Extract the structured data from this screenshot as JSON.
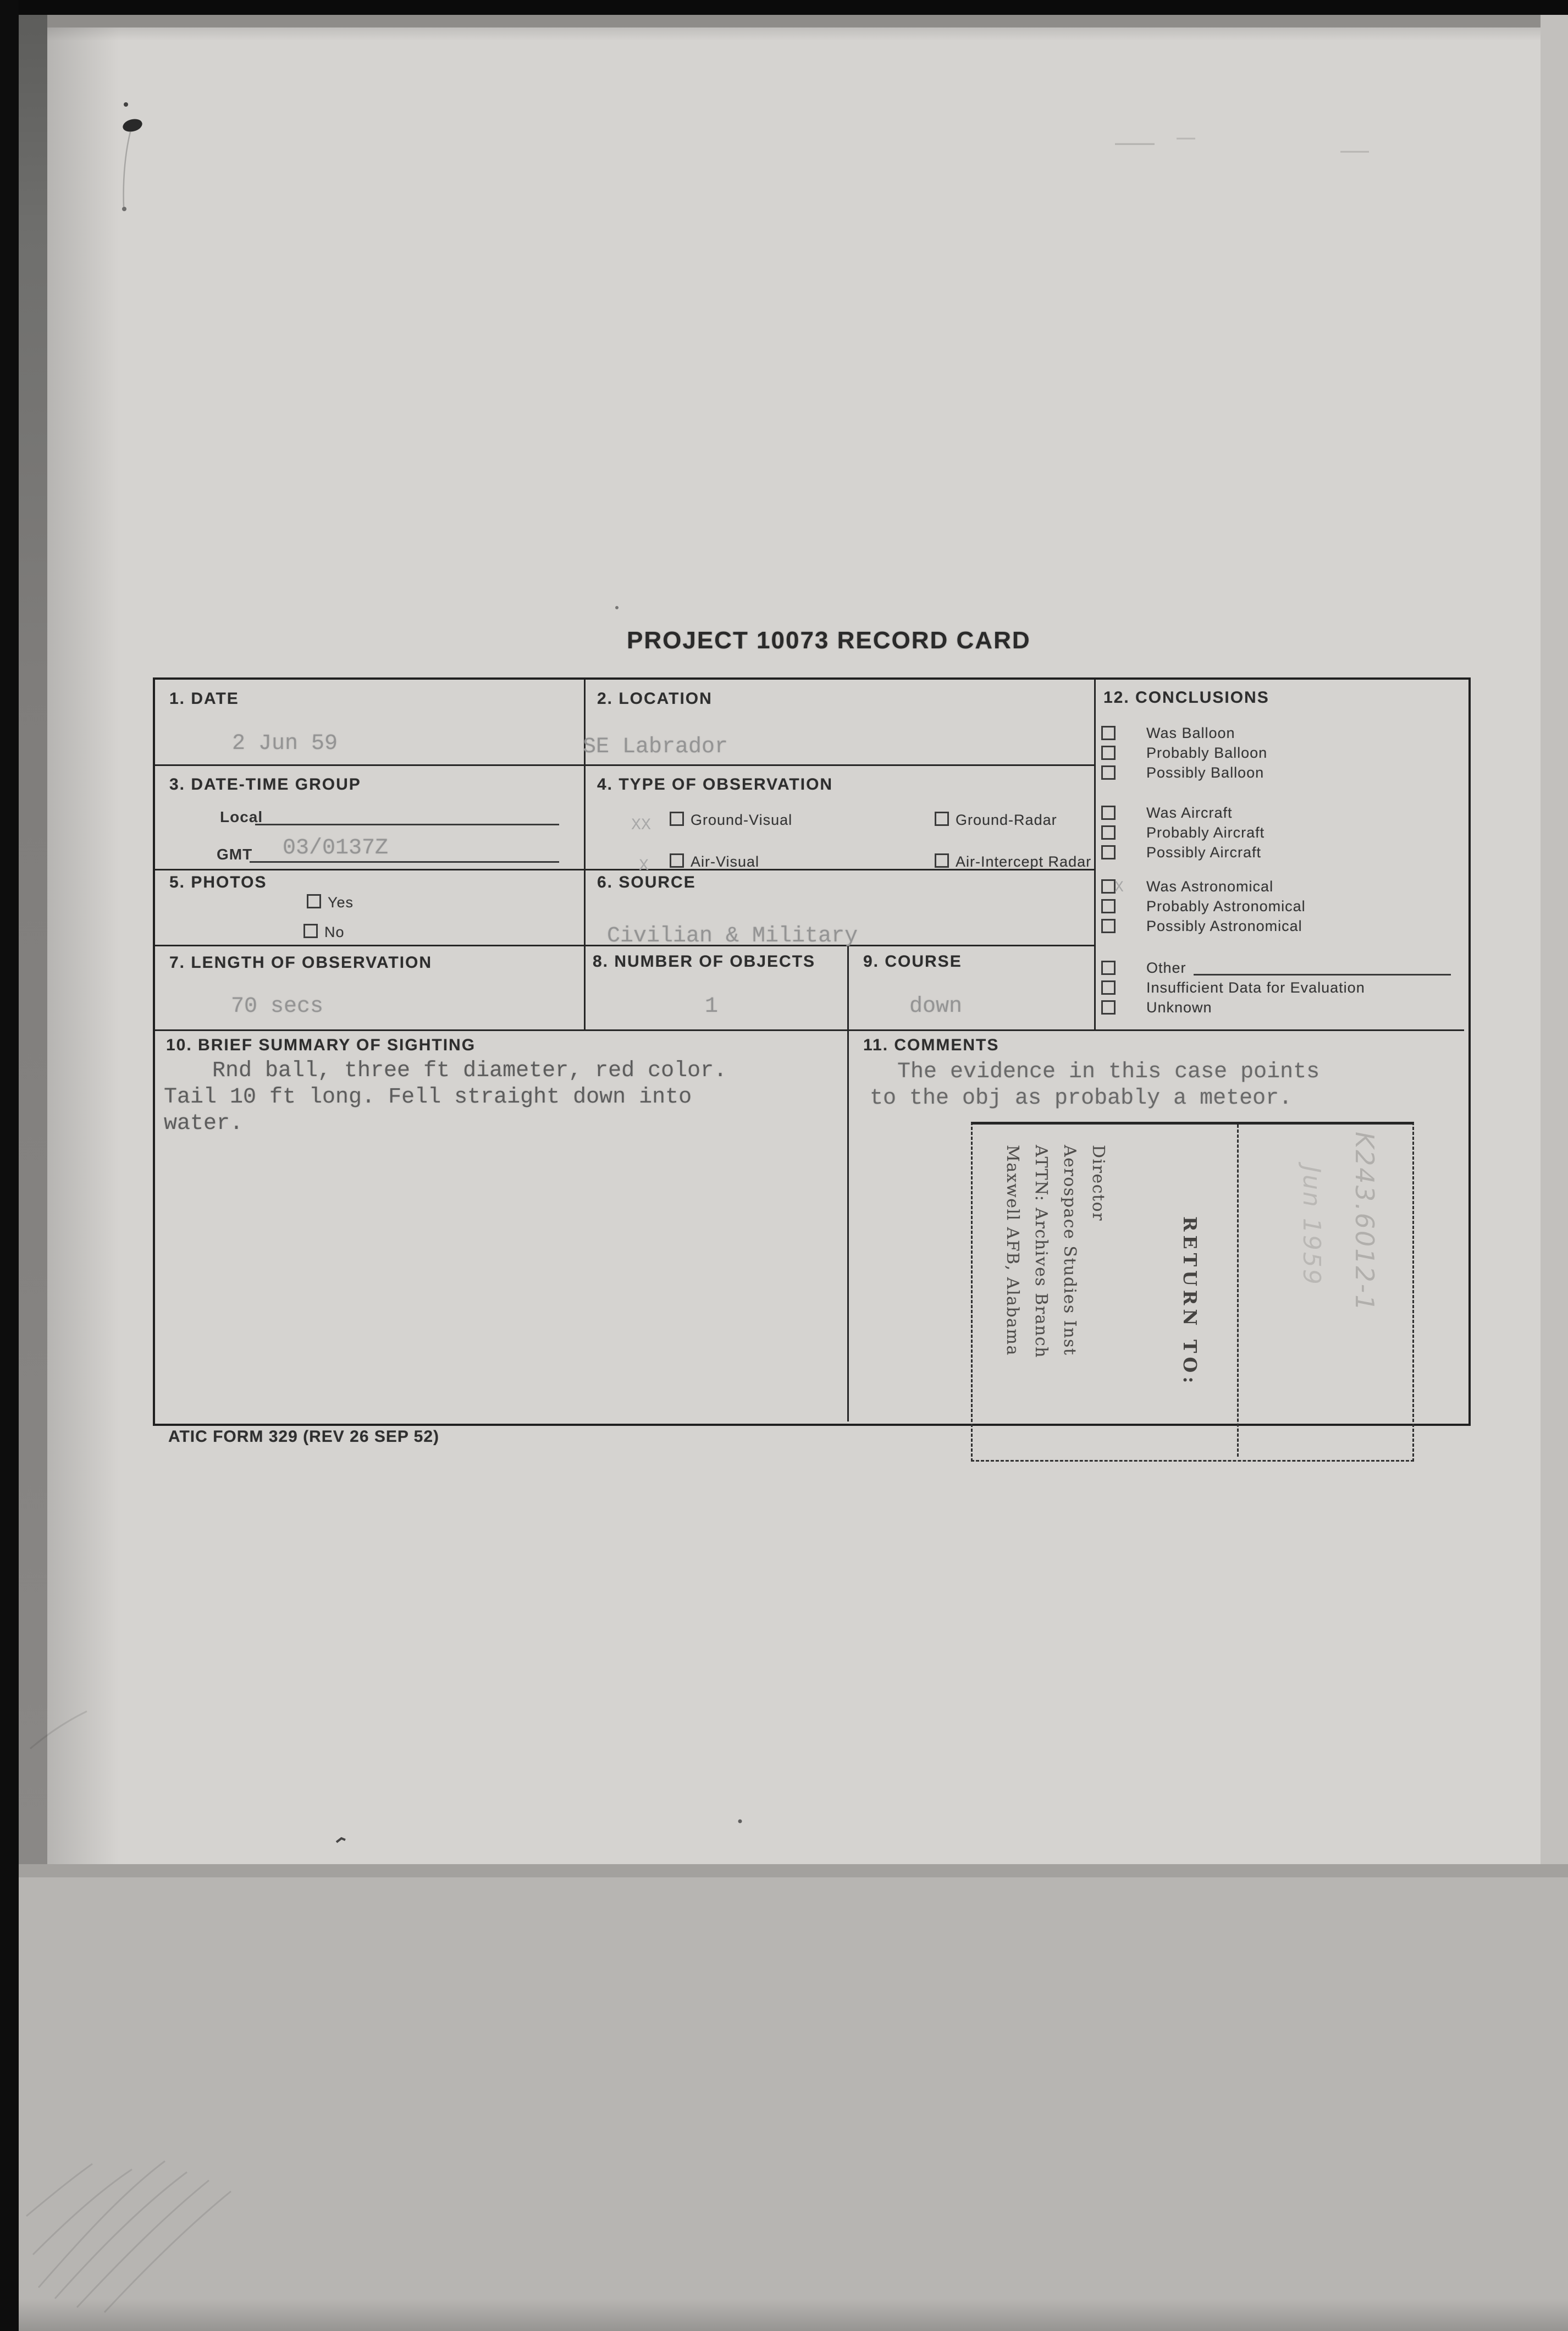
{
  "document": {
    "title": "PROJECT 10073 RECORD CARD",
    "footer": "ATIC FORM 329 (REV 26 SEP 52)"
  },
  "fields": {
    "date": {
      "label": "1. DATE",
      "value": "2 Jun 59"
    },
    "location": {
      "label": "2. LOCATION",
      "value": "SE Labrador"
    },
    "date_time_group": {
      "label": "3. DATE-TIME GROUP",
      "local_label": "Local",
      "gmt_label": "GMT",
      "local_value": "",
      "gmt_value": "03/0137Z"
    },
    "type_of_observation": {
      "label": "4. TYPE OF OBSERVATION",
      "options": [
        {
          "label": "Ground-Visual",
          "mark": "XX"
        },
        {
          "label": "Ground-Radar",
          "mark": ""
        },
        {
          "label": "Air-Visual",
          "mark": "X"
        },
        {
          "label": "Air-Intercept Radar",
          "mark": ""
        }
      ]
    },
    "photos": {
      "label": "5. PHOTOS",
      "options": [
        {
          "label": "Yes",
          "mark": ""
        },
        {
          "label": "No",
          "mark": ""
        }
      ]
    },
    "source": {
      "label": "6. SOURCE",
      "value": "Civilian & Military"
    },
    "length_of_observation": {
      "label": "7. LENGTH OF OBSERVATION",
      "value": "70 secs"
    },
    "number_of_objects": {
      "label": "8. NUMBER OF OBJECTS",
      "value": "1"
    },
    "course": {
      "label": "9. COURSE",
      "value": "down"
    },
    "summary": {
      "label": "10. BRIEF SUMMARY OF SIGHTING",
      "text": "Rnd ball, three ft diameter, red color.\nTail 10 ft long. Fell straight down into\nwater."
    },
    "comments": {
      "label": "11. COMMENTS",
      "text": "The evidence in this case points\nto the obj as probably a meteor."
    },
    "conclusions": {
      "label": "12. CONCLUSIONS",
      "items": [
        {
          "label": "Was Balloon",
          "mark": ""
        },
        {
          "label": "Probably Balloon",
          "mark": ""
        },
        {
          "label": "Possibly Balloon",
          "mark": ""
        },
        {
          "label": "Was Aircraft",
          "mark": ""
        },
        {
          "label": "Probably Aircraft",
          "mark": ""
        },
        {
          "label": "Possibly Aircraft",
          "mark": ""
        },
        {
          "label": "Was Astronomical",
          "mark": "X"
        },
        {
          "label": "Probably Astronomical",
          "mark": ""
        },
        {
          "label": "Possibly Astronomical",
          "mark": ""
        },
        {
          "label": "Other",
          "mark": ""
        },
        {
          "label": "Insufficient Data for Evaluation",
          "mark": ""
        },
        {
          "label": "Unknown",
          "mark": ""
        }
      ]
    }
  },
  "stamp": {
    "return_to": "RETURN TO:",
    "address": "Director\nAerospace Studies Inst\nATTN: Archives Branch\nMaxwell AFB, Alabama"
  },
  "handwriting": {
    "reference": "K243.6012-1",
    "date": "Jun 1959"
  }
}
